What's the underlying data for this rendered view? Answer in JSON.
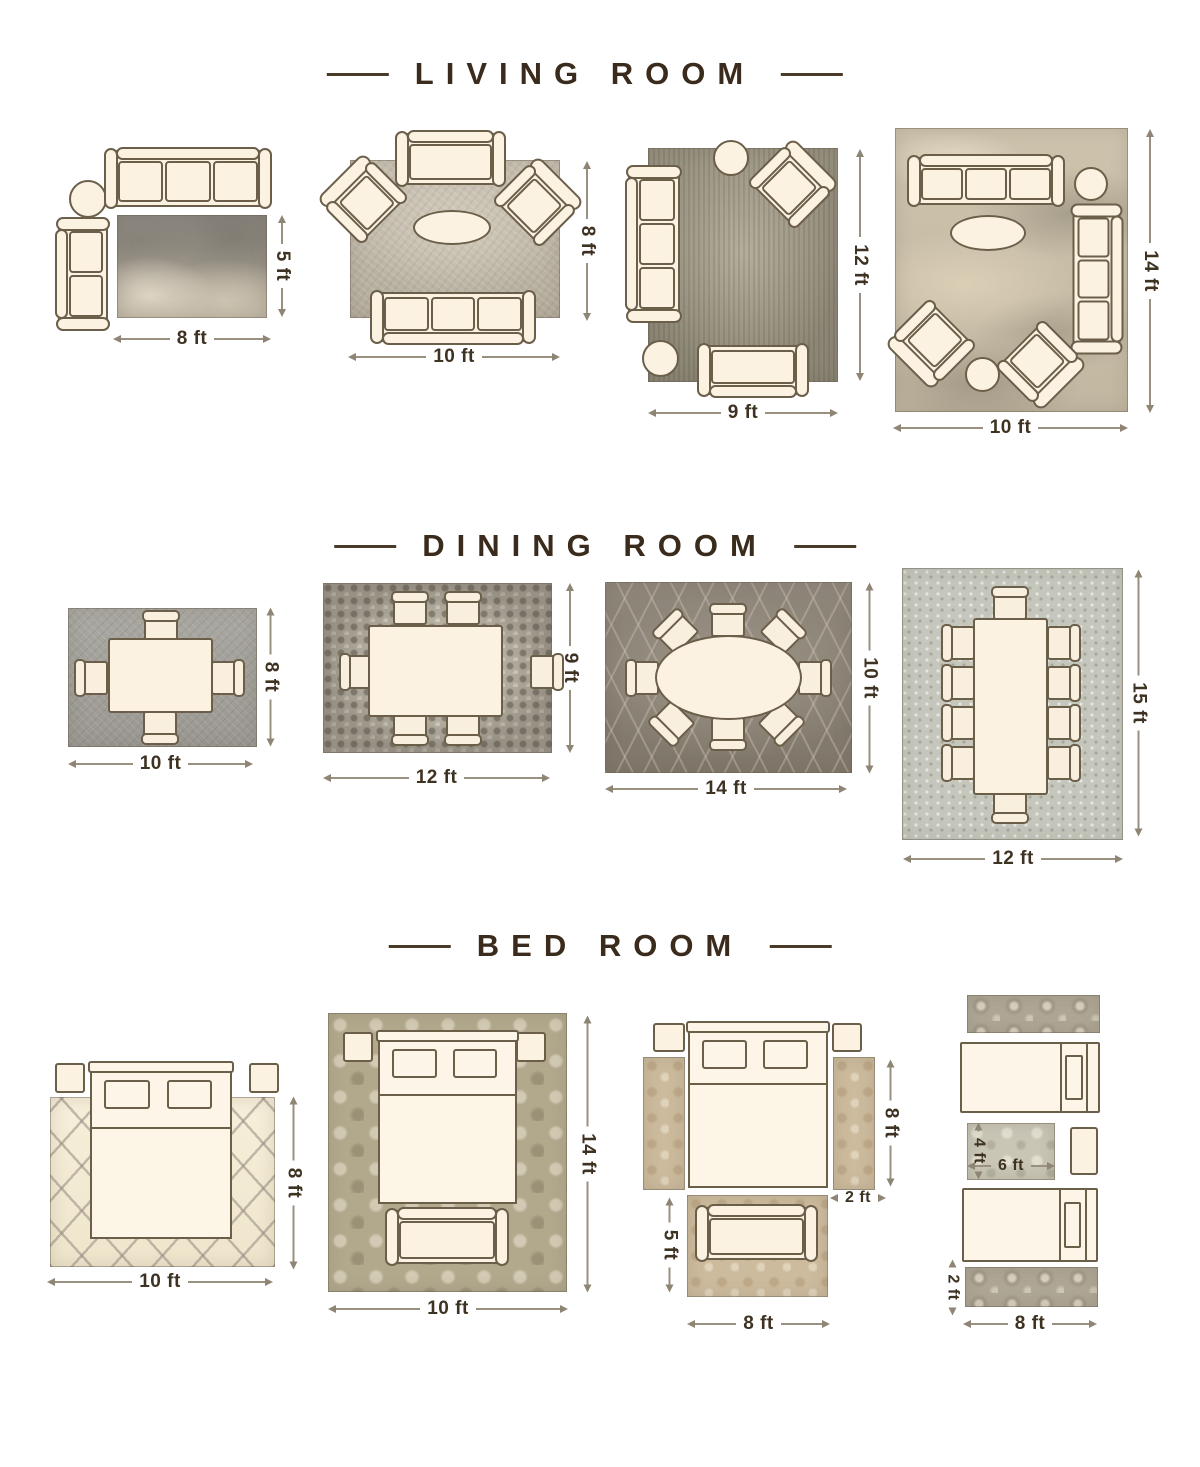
{
  "meta": {
    "canvas_width": 1200,
    "canvas_height": 1467,
    "background": "#ffffff"
  },
  "colors": {
    "title_text": "#3a2b1c",
    "title_rule": "#4a3a28",
    "dimension_text": "#3e3222",
    "dimension_line": "#9a9080",
    "furniture_fill": "#fbf2e2",
    "furniture_outline": "#6b5f4a"
  },
  "sections": [
    {
      "title": "LIVING ROOM",
      "diagrams": [
        {
          "rug_style": "distressed-gray",
          "width_label": "8 ft",
          "height_label": "5 ft",
          "furniture": [
            "sofa-3-seat",
            "round-side-table",
            "loveseat",
            "area-rug"
          ]
        },
        {
          "rug_style": "light-textured-gray",
          "width_label": "10 ft",
          "height_label": "8 ft",
          "furniture": [
            "settee",
            "armchair",
            "armchair",
            "oval-coffee-table",
            "sofa-3-seat",
            "area-rug"
          ]
        },
        {
          "rug_style": "vintage-distressed",
          "width_label": "9 ft",
          "height_label": "12 ft",
          "furniture": [
            "round-ottoman",
            "armchair",
            "sofa-3-seat",
            "round-side-table",
            "settee",
            "area-rug"
          ]
        },
        {
          "rug_style": "abstract-beige-gray",
          "width_label": "10 ft",
          "height_label": "14 ft",
          "furniture": [
            "sofa-3-seat",
            "round-side-table",
            "sofa-3-seat",
            "oval-coffee-table",
            "armchair",
            "armchair",
            "round-ottoman",
            "area-rug"
          ]
        }
      ]
    },
    {
      "title": "DINING ROOM",
      "diagrams": [
        {
          "rug_style": "gray-crosshatch",
          "width_label": "10 ft",
          "height_label": "8 ft",
          "furniture": [
            "dining-table",
            "dining-chair-x4",
            "area-rug"
          ]
        },
        {
          "rug_style": "mosaic-pebble",
          "width_label": "12 ft",
          "height_label": "9 ft",
          "furniture": [
            "dining-table",
            "dining-chair-x6",
            "area-rug"
          ]
        },
        {
          "rug_style": "dark-trellis",
          "width_label": "14 ft",
          "height_label": "10 ft",
          "furniture": [
            "oval-dining-table",
            "dining-chair-x8",
            "area-rug"
          ]
        },
        {
          "rug_style": "light-flecked",
          "width_label": "12 ft",
          "height_label": "15 ft",
          "furniture": [
            "dining-table",
            "dining-chair-x10",
            "area-rug"
          ]
        }
      ]
    },
    {
      "title": "BED ROOM",
      "diagrams": [
        {
          "rug_style": "cream-diamond-lattice",
          "width_label": "10 ft",
          "height_label": "8 ft",
          "furniture": [
            "bed",
            "nightstand-x2",
            "area-rug"
          ]
        },
        {
          "rug_style": "olive-damask",
          "width_label": "10 ft",
          "height_label": "14 ft",
          "furniture": [
            "bed",
            "nightstand-x2",
            "bench",
            "area-rug"
          ]
        },
        {
          "rug_style": "vintage-tan",
          "width_label": "8 ft",
          "foot_rug_height_label": "5 ft",
          "bed_side_height_label": "8 ft",
          "runner_width_label": "2 ft",
          "furniture": [
            "bed",
            "nightstand-x2",
            "runner-rug-x2",
            "foot-rug",
            "bench"
          ]
        },
        {
          "rug_style": "ornate-runner",
          "center_rug_width_label": "6 ft",
          "center_rug_height_label": "4 ft",
          "bottom_runner_height_label": "2 ft",
          "bottom_runner_width_label": "8 ft",
          "furniture": [
            "twin-bed-x2",
            "runner-rug-x2",
            "center-rug",
            "nightstand"
          ]
        }
      ]
    }
  ]
}
